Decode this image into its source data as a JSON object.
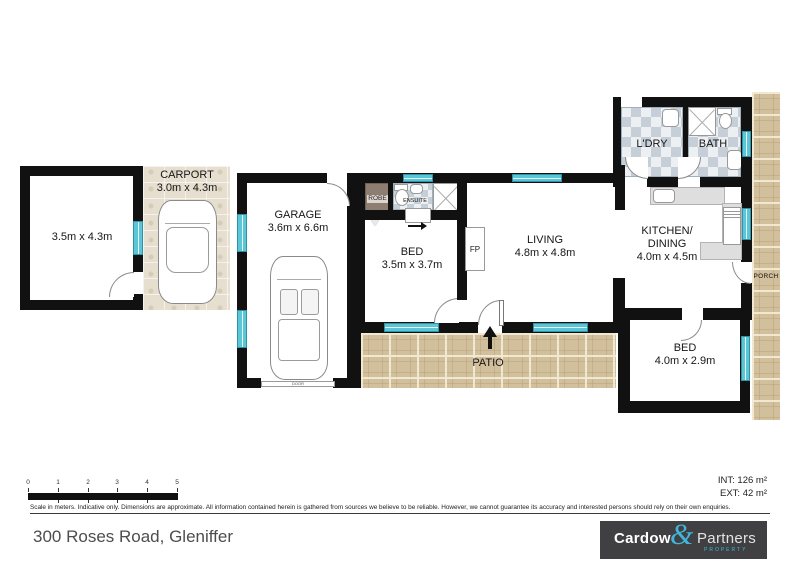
{
  "plan": {
    "store": {
      "dims": "3.5m x 4.3m"
    },
    "carport": {
      "name": "CARPORT",
      "dims": "3.0m x 4.3m"
    },
    "garage": {
      "name": "GARAGE",
      "dims": "3.6m x 6.6m",
      "door_label": "DOOR"
    },
    "bed1": {
      "name": "BED",
      "dims": "3.5m x 3.7m"
    },
    "robe": {
      "label": "ROBE"
    },
    "ensuite": {
      "label": "ENSUITE"
    },
    "living": {
      "name": "LIVING",
      "dims": "4.8m x 4.8m"
    },
    "fireplace": {
      "label": "FP"
    },
    "kitchen": {
      "name1": "KITCHEN/",
      "name2": "DINING",
      "dims": "4.0m x 4.5m"
    },
    "ldry": {
      "name": "L'DRY"
    },
    "bath": {
      "name": "BATH"
    },
    "bed2": {
      "name": "BED",
      "dims": "4.0m x 2.9m"
    },
    "patio": {
      "name": "PATIO"
    },
    "porch": {
      "name": "PORCH"
    }
  },
  "scale_bar": {
    "ticks": [
      "0",
      "1",
      "2",
      "3",
      "4",
      "5"
    ]
  },
  "areas": {
    "internal": "INT: 126 m²",
    "external": "EXT: 42 m²"
  },
  "disclaimer": "Scale in meters. Indicative only. Dimensions are approximate. All information contained herein is gathered from sources we believe to be reliable. However, we cannot guarantee its accuracy and interested persons should rely on their own enquiries.",
  "address": "300 Roses Road, Gleniffer",
  "logo": {
    "name1": "Cardow",
    "amp": "&",
    "name2": "Partners",
    "tagline": "PROPERTY"
  },
  "colors": {
    "wall": "#111111",
    "window": "#5ac6d6",
    "paver": "#d2bf9c",
    "logo_bg": "#404042",
    "accent": "#41b6dc"
  }
}
